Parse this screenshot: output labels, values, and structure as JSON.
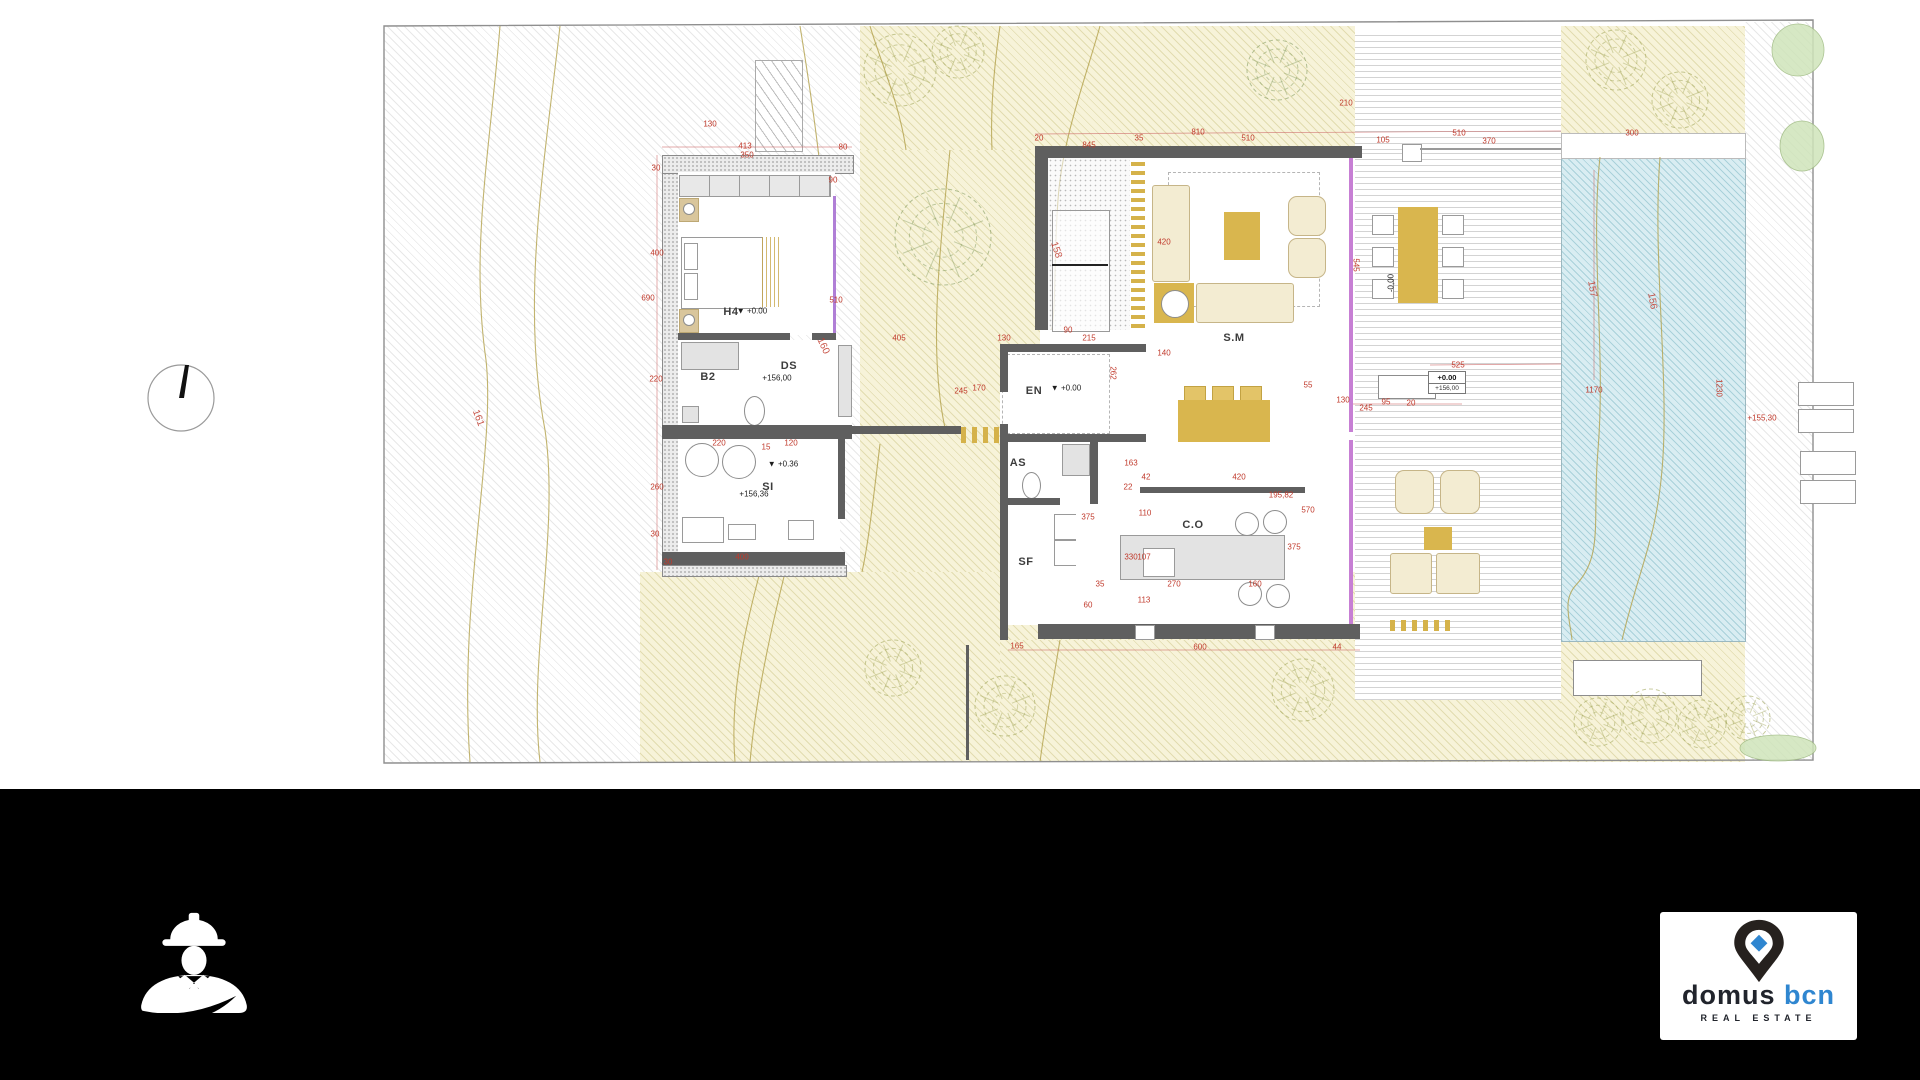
{
  "sheet": {
    "type": "architectural-site-floor-plan"
  },
  "colors": {
    "dim_red": "#c0392b",
    "wall_gray": "#5f5f5f",
    "glass_violet": "#c77fd4",
    "gold": "#d9b64e",
    "garden": "#f7f3d9",
    "pool_blue": "#d9edf2",
    "brand_dark": "#21242c",
    "brand_blue": "#2f86d0",
    "footer_black": "#000000"
  },
  "plan": {
    "room_labels": [
      {
        "t": "H4",
        "x": 731,
        "y": 312
      },
      {
        "t": "B2",
        "x": 708,
        "y": 377
      },
      {
        "t": "DS",
        "x": 789,
        "y": 366
      },
      {
        "t": "SI",
        "x": 768,
        "y": 487
      },
      {
        "t": "EN",
        "x": 1034,
        "y": 391
      },
      {
        "t": "AS",
        "x": 1018,
        "y": 463
      },
      {
        "t": "SF",
        "x": 1026,
        "y": 562
      },
      {
        "t": "S.M",
        "x": 1234,
        "y": 338
      },
      {
        "t": "C.O",
        "x": 1193,
        "y": 525
      }
    ],
    "elevation_texts": [
      {
        "t": "▼ +0.00",
        "x": 752,
        "y": 311
      },
      {
        "t": "+156,00",
        "x": 777,
        "y": 378
      },
      {
        "t": "▼ +0.36",
        "x": 783,
        "y": 464
      },
      {
        "t": "+156,36",
        "x": 754,
        "y": 494
      },
      {
        "t": "▼ +0.00",
        "x": 1066,
        "y": 388
      },
      {
        "t": "-0,00",
        "x": 1391,
        "y": 283,
        "r": -90
      }
    ],
    "level_box": {
      "line1": "+0.00",
      "line2": "+156,00"
    },
    "contour_labels": [
      {
        "t": "161",
        "x": 478,
        "y": 418,
        "r": 70
      },
      {
        "t": "160",
        "x": 823,
        "y": 346,
        "r": 65
      },
      {
        "t": "158",
        "x": 1056,
        "y": 250,
        "r": 72
      },
      {
        "t": "157",
        "x": 1592,
        "y": 289,
        "r": 80
      },
      {
        "t": "156",
        "x": 1652,
        "y": 301,
        "r": 80
      }
    ],
    "dimension_texts": [
      {
        "t": "130",
        "x": 710,
        "y": 124
      },
      {
        "t": "413",
        "x": 745,
        "y": 146
      },
      {
        "t": "350",
        "x": 747,
        "y": 155
      },
      {
        "t": "80",
        "x": 843,
        "y": 147
      },
      {
        "t": "30",
        "x": 656,
        "y": 168
      },
      {
        "t": "90",
        "x": 833,
        "y": 180
      },
      {
        "t": "400",
        "x": 657,
        "y": 253
      },
      {
        "t": "690",
        "x": 648,
        "y": 298
      },
      {
        "t": "510",
        "x": 836,
        "y": 300
      },
      {
        "t": "220",
        "x": 656,
        "y": 379
      },
      {
        "t": "405",
        "x": 899,
        "y": 338
      },
      {
        "t": "130",
        "x": 1004,
        "y": 338
      },
      {
        "t": "245",
        "x": 961,
        "y": 391
      },
      {
        "t": "170",
        "x": 979,
        "y": 388
      },
      {
        "t": "220",
        "x": 719,
        "y": 443
      },
      {
        "t": "15",
        "x": 766,
        "y": 447
      },
      {
        "t": "120",
        "x": 791,
        "y": 443
      },
      {
        "t": "260",
        "x": 657,
        "y": 487
      },
      {
        "t": "30",
        "x": 655,
        "y": 534
      },
      {
        "t": "400",
        "x": 742,
        "y": 557
      },
      {
        "t": "30",
        "x": 668,
        "y": 562
      },
      {
        "t": "20",
        "x": 1039,
        "y": 138
      },
      {
        "t": "845",
        "x": 1089,
        "y": 145
      },
      {
        "t": "35",
        "x": 1139,
        "y": 138
      },
      {
        "t": "810",
        "x": 1198,
        "y": 132
      },
      {
        "t": "510",
        "x": 1248,
        "y": 138
      },
      {
        "t": "210",
        "x": 1346,
        "y": 103
      },
      {
        "t": "105",
        "x": 1383,
        "y": 140
      },
      {
        "t": "510",
        "x": 1459,
        "y": 133
      },
      {
        "t": "370",
        "x": 1489,
        "y": 141
      },
      {
        "t": "300",
        "x": 1632,
        "y": 133
      },
      {
        "t": "420",
        "x": 1164,
        "y": 242
      },
      {
        "t": "545",
        "x": 1356,
        "y": 265,
        "r": 90
      },
      {
        "t": "90",
        "x": 1068,
        "y": 330
      },
      {
        "t": "215",
        "x": 1089,
        "y": 338
      },
      {
        "t": "140",
        "x": 1164,
        "y": 353
      },
      {
        "t": "262",
        "x": 1113,
        "y": 373,
        "r": 90
      },
      {
        "t": "525",
        "x": 1458,
        "y": 365
      },
      {
        "t": "55",
        "x": 1308,
        "y": 385
      },
      {
        "t": "130",
        "x": 1343,
        "y": 400
      },
      {
        "t": "95",
        "x": 1386,
        "y": 402
      },
      {
        "t": "20",
        "x": 1411,
        "y": 403
      },
      {
        "t": "245",
        "x": 1366,
        "y": 408
      },
      {
        "t": "1170",
        "x": 1594,
        "y": 390
      },
      {
        "t": "1230",
        "x": 1719,
        "y": 388,
        "r": 90
      },
      {
        "t": "+155,30",
        "x": 1762,
        "y": 418
      },
      {
        "t": "195,82",
        "x": 1281,
        "y": 495
      },
      {
        "t": "570",
        "x": 1308,
        "y": 510
      },
      {
        "t": "163",
        "x": 1131,
        "y": 463
      },
      {
        "t": "42",
        "x": 1146,
        "y": 477
      },
      {
        "t": "420",
        "x": 1239,
        "y": 477
      },
      {
        "t": "22",
        "x": 1128,
        "y": 487
      },
      {
        "t": "110",
        "x": 1145,
        "y": 513
      },
      {
        "t": "375",
        "x": 1088,
        "y": 517
      },
      {
        "t": "330",
        "x": 1131,
        "y": 557
      },
      {
        "t": "107",
        "x": 1144,
        "y": 557
      },
      {
        "t": "35",
        "x": 1100,
        "y": 584
      },
      {
        "t": "270",
        "x": 1174,
        "y": 584
      },
      {
        "t": "160",
        "x": 1255,
        "y": 584
      },
      {
        "t": "60",
        "x": 1088,
        "y": 605
      },
      {
        "t": "113",
        "x": 1144,
        "y": 600
      },
      {
        "t": "375",
        "x": 1294,
        "y": 547
      },
      {
        "t": "165",
        "x": 1017,
        "y": 646
      },
      {
        "t": "600",
        "x": 1200,
        "y": 647
      },
      {
        "t": "44",
        "x": 1337,
        "y": 647
      }
    ]
  },
  "footer": {
    "logo": {
      "brand_primary": "domus",
      "brand_secondary": "bcn",
      "tagline": "REAL ESTATE"
    }
  }
}
